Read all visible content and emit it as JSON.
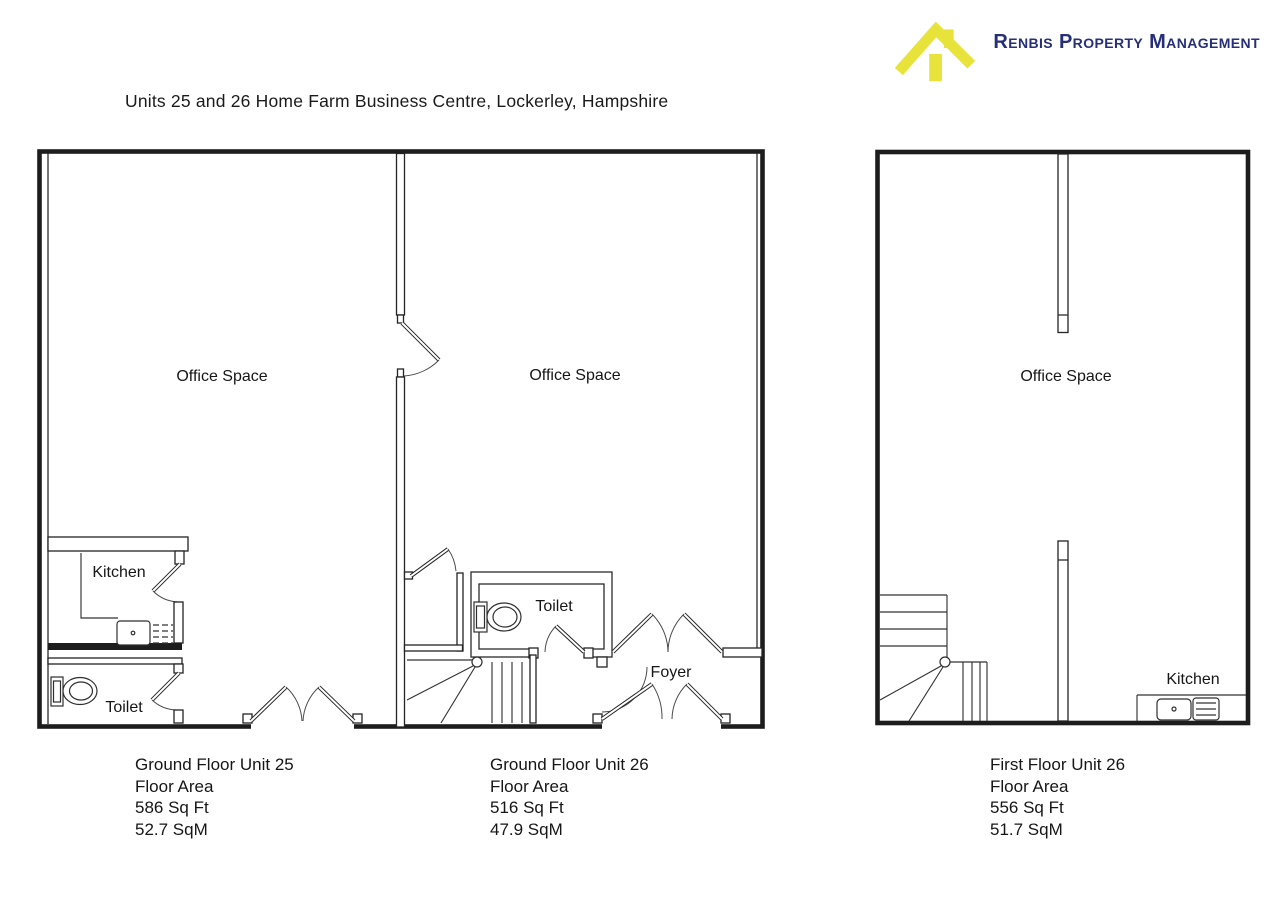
{
  "header": {
    "brand": "Renbis Property Management",
    "brand_color": "#262f78",
    "logo_icon": "house-icon",
    "logo_color": "#e8e33b",
    "title": "Units 25 and 26 Home Farm Business Centre, Lockerley, Hampshire"
  },
  "plans": [
    {
      "name": "ground-floor-unit-25",
      "rooms": {
        "office": "Office Space",
        "kitchen": "Kitchen",
        "toilet": "Toilet"
      },
      "caption": [
        "Ground Floor Unit 25",
        "Floor Area",
        "586 Sq Ft",
        "52.7 SqM"
      ]
    },
    {
      "name": "ground-floor-unit-26",
      "rooms": {
        "office": "Office Space",
        "toilet": "Toilet",
        "foyer": "Foyer"
      },
      "caption": [
        "Ground Floor Unit 26",
        "Floor Area",
        "516 Sq Ft",
        "47.9 SqM"
      ]
    },
    {
      "name": "first-floor-unit-26",
      "rooms": {
        "office": "Office Space",
        "kitchen": "Kitchen"
      },
      "caption": [
        "First Floor Unit 26",
        "Floor Area",
        "556 Sq Ft",
        "51.7 SqM"
      ]
    }
  ]
}
